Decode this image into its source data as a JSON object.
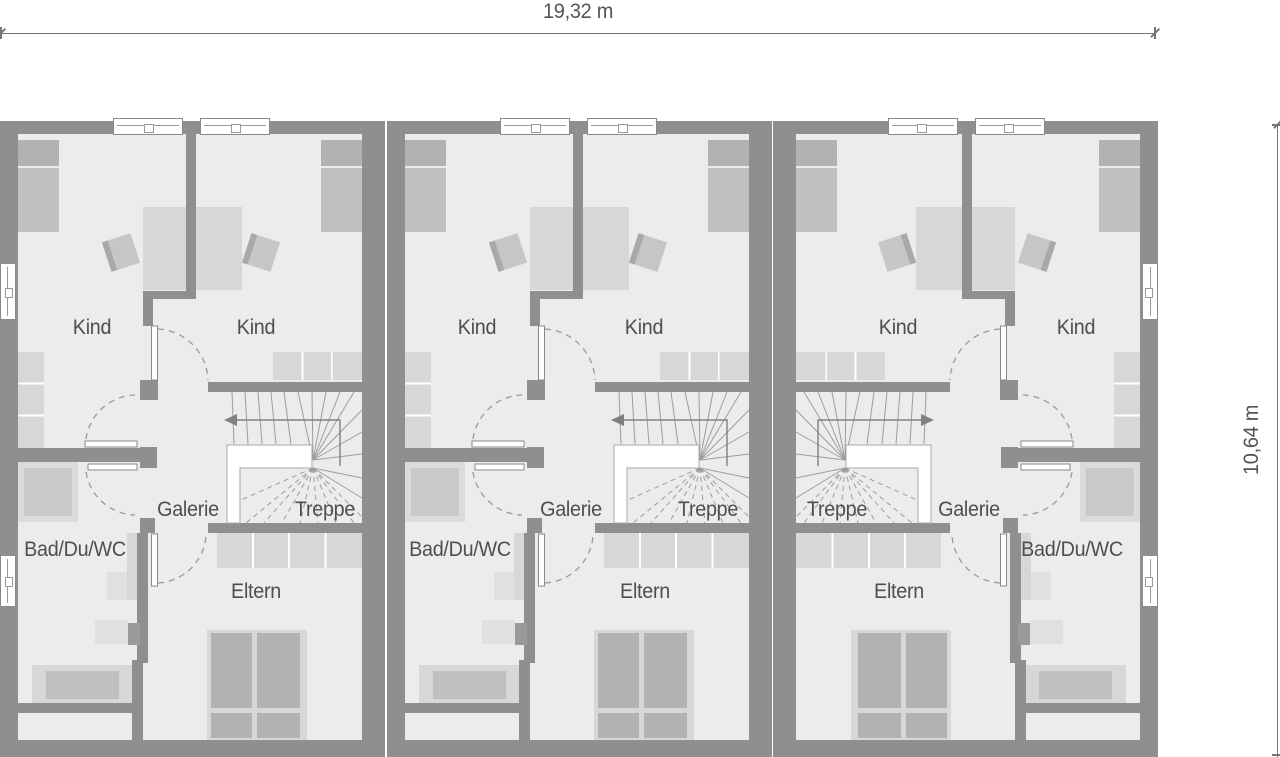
{
  "title": "Dachgeschoss Grundriss - Reihenhaus mit 3 Einheiten",
  "dimension_top": {
    "label": "19,32 m"
  },
  "dimension_right": {
    "label": "10,64 m"
  },
  "floorplan": {
    "colors": {
      "wall": "#8f8f8f",
      "floor": "#ececec",
      "furniture_light": "#d7d7d7",
      "furniture_medium": "#c0c0c0",
      "furniture_dark": "#b2b2b2",
      "line": "#9a9a9a",
      "text": "#555555"
    },
    "room_names": [
      "Kind",
      "Kind",
      "Galerie",
      "Treppe",
      "Bad/Du/WC",
      "Eltern"
    ],
    "units": [
      {
        "id": "house-1",
        "x": 0,
        "mirrored": false,
        "side_windows": true,
        "room_labels": [
          {
            "name": "kind-left",
            "text": "Kind",
            "x": 92,
            "y": 328
          },
          {
            "name": "kind-right",
            "text": "Kind",
            "x": 256,
            "y": 328
          },
          {
            "name": "galerie",
            "text": "Galerie",
            "x": 188,
            "y": 510
          },
          {
            "name": "treppe",
            "text": "Treppe",
            "x": 325,
            "y": 510
          },
          {
            "name": "bad-du-wc",
            "text": "Bad/Du/WC",
            "x": 75,
            "y": 550
          },
          {
            "name": "eltern",
            "text": "Eltern",
            "x": 256,
            "y": 592
          }
        ]
      },
      {
        "id": "house-2",
        "x": 386.5,
        "mirrored": false,
        "side_windows": false,
        "room_labels": [
          {
            "name": "kind-left",
            "text": "Kind",
            "x": 477,
            "y": 328
          },
          {
            "name": "kind-right",
            "text": "Kind",
            "x": 644,
            "y": 328
          },
          {
            "name": "galerie",
            "text": "Galerie",
            "x": 571,
            "y": 510
          },
          {
            "name": "treppe",
            "text": "Treppe",
            "x": 708,
            "y": 510
          },
          {
            "name": "bad-du-wc",
            "text": "Bad/Du/WC",
            "x": 460,
            "y": 550
          },
          {
            "name": "eltern",
            "text": "Eltern",
            "x": 645,
            "y": 592
          }
        ]
      },
      {
        "id": "house-3",
        "x": 773,
        "mirrored": true,
        "side_windows": true,
        "room_labels": [
          {
            "name": "kind-left",
            "text": "Kind",
            "x": 898,
            "y": 328
          },
          {
            "name": "kind-right",
            "text": "Kind",
            "x": 1076,
            "y": 328
          },
          {
            "name": "galerie",
            "text": "Galerie",
            "x": 969,
            "y": 510
          },
          {
            "name": "treppe",
            "text": "Treppe",
            "x": 837,
            "y": 510
          },
          {
            "name": "bad-du-wc",
            "text": "Bad/Du/WC",
            "x": 1072,
            "y": 550
          },
          {
            "name": "eltern",
            "text": "Eltern",
            "x": 899,
            "y": 592
          }
        ]
      }
    ]
  }
}
